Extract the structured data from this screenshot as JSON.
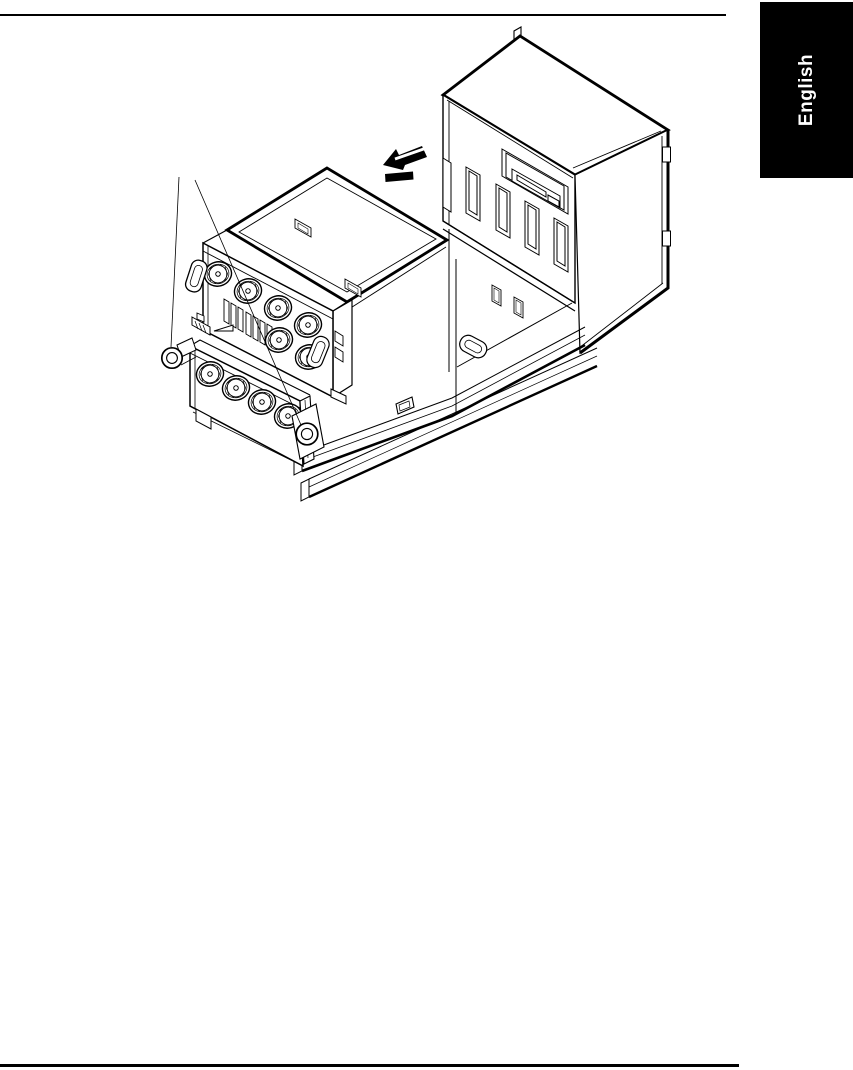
{
  "page": {
    "background_color": "#ffffff",
    "rule_color": "#000000"
  },
  "language_tab": {
    "label": "English",
    "background_color": "#000000",
    "text_color": "#ffffff"
  },
  "figure": {
    "type": "technical-line-illustration",
    "line_color": "#000000",
    "fill_color": "#ffffff",
    "parts": [
      "system-chassis",
      "fan-assembly-module-upper",
      "fan-assembly-module-lower",
      "removal-direction-arrow",
      "pull-ring-left",
      "pull-ring-bottom",
      "slide-rails",
      "leader-lines"
    ],
    "visible_fan_count_upper": 6,
    "visible_fan_count_lower": 4,
    "chassis_slot_count": 5
  }
}
